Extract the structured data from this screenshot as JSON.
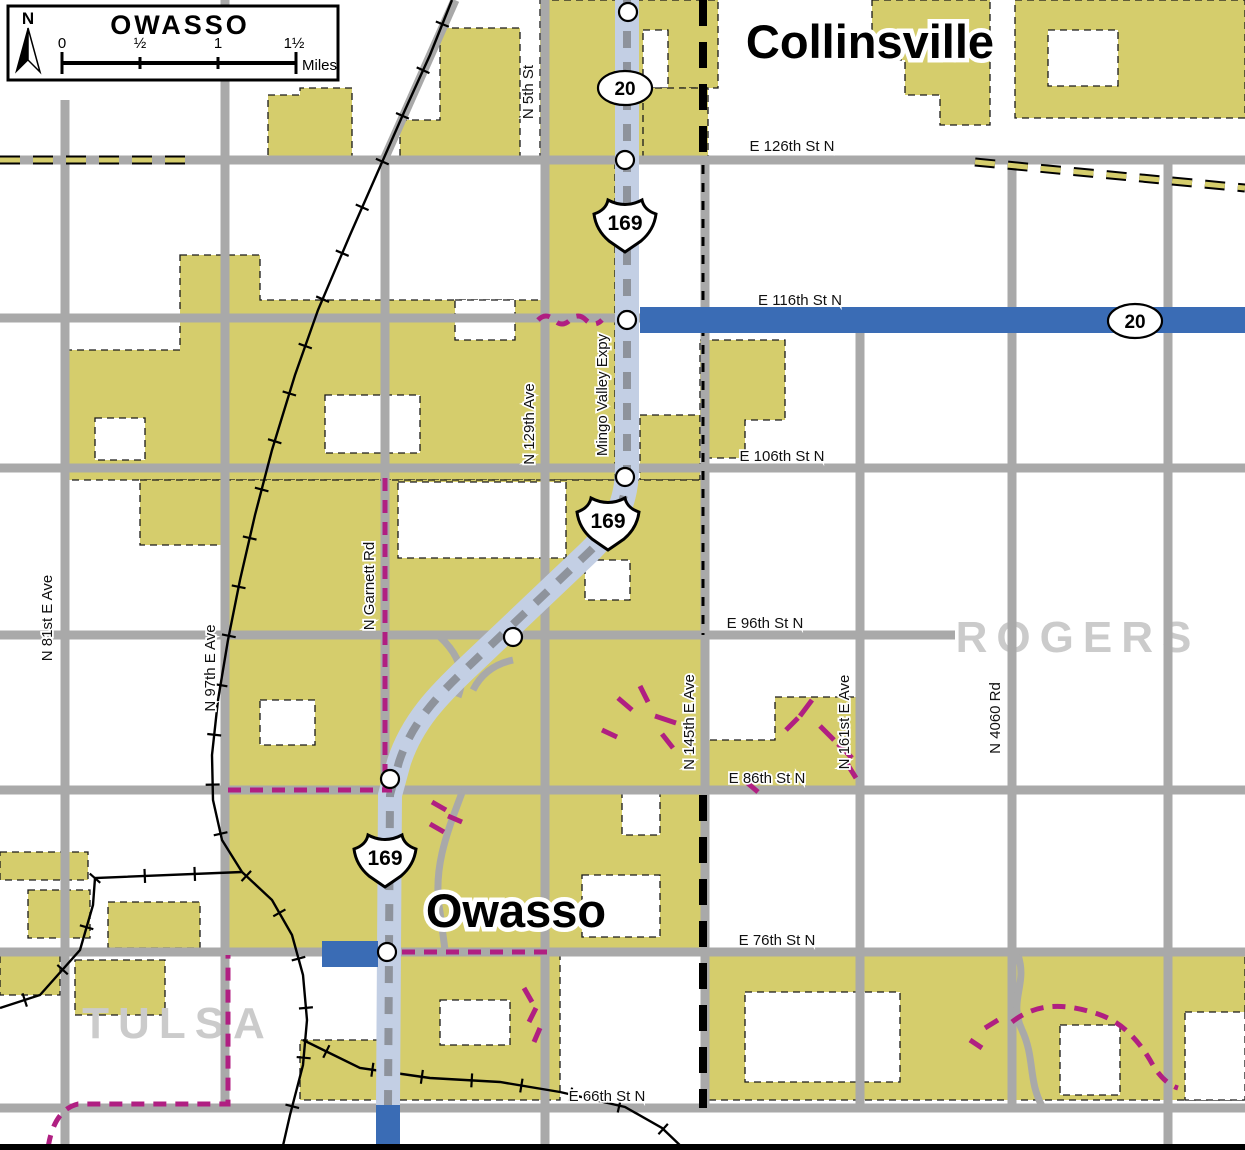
{
  "title_box": {
    "title": "OWASSO",
    "north_label": "N",
    "scale_ticks": [
      "0",
      "½",
      "1",
      "1½"
    ],
    "units_label": "Miles"
  },
  "city_labels": [
    {
      "text": "Collinsville",
      "x": 870,
      "y": 58
    },
    {
      "text": "Owasso",
      "x": 516,
      "y": 927
    }
  ],
  "area_labels": [
    {
      "text": "ROGERS",
      "x": 1078,
      "y": 652
    },
    {
      "text": "TULSA",
      "x": 178,
      "y": 1038
    }
  ],
  "street_labels_h": [
    {
      "text": "E 126th St N",
      "x": 792,
      "y": 151
    },
    {
      "text": "E 116th St N",
      "x": 800,
      "y": 305
    },
    {
      "text": "E 106th St N",
      "x": 782,
      "y": 461
    },
    {
      "text": "E 96th St N",
      "x": 765,
      "y": 628
    },
    {
      "text": "E 86th St N",
      "x": 767,
      "y": 783
    },
    {
      "text": "E 76th St N",
      "x": 777,
      "y": 945
    },
    {
      "text": "E 66th St N",
      "x": 607,
      "y": 1101
    }
  ],
  "street_labels_v": [
    {
      "text": "N 5th St",
      "x": 533,
      "y": 92
    },
    {
      "text": "N 129th Ave",
      "x": 534,
      "y": 424
    },
    {
      "text": "Mingo Valley Expy",
      "x": 607,
      "y": 395
    },
    {
      "text": "N Garnett Rd",
      "x": 374,
      "y": 586
    },
    {
      "text": "N 81st E Ave",
      "x": 52,
      "y": 618
    },
    {
      "text": "N 97th E Ave",
      "x": 215,
      "y": 668
    },
    {
      "text": "N 145th E Ave",
      "x": 694,
      "y": 722
    },
    {
      "text": "N 161st E Ave",
      "x": 849,
      "y": 722
    },
    {
      "text": "N 4060 Rd",
      "x": 1000,
      "y": 718
    }
  ],
  "us_route_shields": [
    {
      "text": "169",
      "x": 625,
      "y": 222
    },
    {
      "text": "169",
      "x": 608,
      "y": 520
    },
    {
      "text": "169",
      "x": 385,
      "y": 857
    }
  ],
  "oval_route_shields": [
    {
      "text": "20",
      "x": 625,
      "y": 88
    },
    {
      "text": "20",
      "x": 1135,
      "y": 321
    }
  ],
  "colors": {
    "urban_fill": "#d5cd6c",
    "road_gray": "#a9a9a9",
    "expressway_fill": "#c3cfe4",
    "highway_blue": "#3a6cb5",
    "trail_magenta": "#b01f82",
    "area_label_gray": "#cbcbcb"
  }
}
